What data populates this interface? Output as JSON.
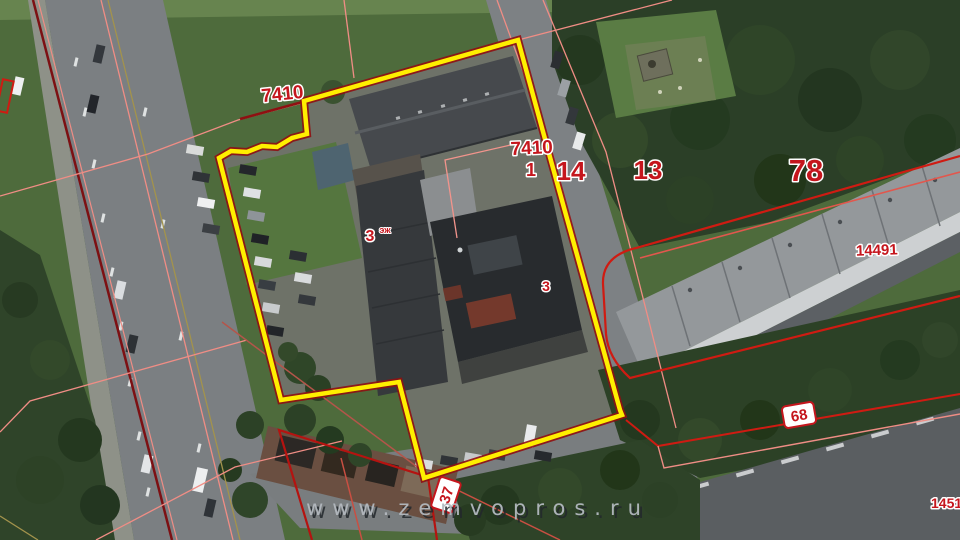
{
  "map": {
    "watermark": "www.zemvopros.ru",
    "highlight_color": "#ffef00",
    "cadastral_color": "#cf1b12",
    "labels": [
      {
        "id": "parcel-7410-nw",
        "text": "7410"
      },
      {
        "id": "parcel-7410-center",
        "text": "7410"
      },
      {
        "id": "unit-1",
        "text": "1"
      },
      {
        "id": "road-parcel-14",
        "text": "14"
      },
      {
        "id": "parcel-13",
        "text": "13"
      },
      {
        "id": "parcel-78",
        "text": "78"
      },
      {
        "id": "parcel-14491",
        "text": "14491"
      },
      {
        "id": "building-floors-3",
        "text": "3"
      },
      {
        "id": "building-floors-sup",
        "text": "эж"
      },
      {
        "id": "building-3",
        "text": "3"
      },
      {
        "id": "parcel-1451",
        "text": "1451"
      },
      {
        "id": "badge-68",
        "text": "68"
      },
      {
        "id": "badge-37",
        "text": "37"
      }
    ]
  }
}
